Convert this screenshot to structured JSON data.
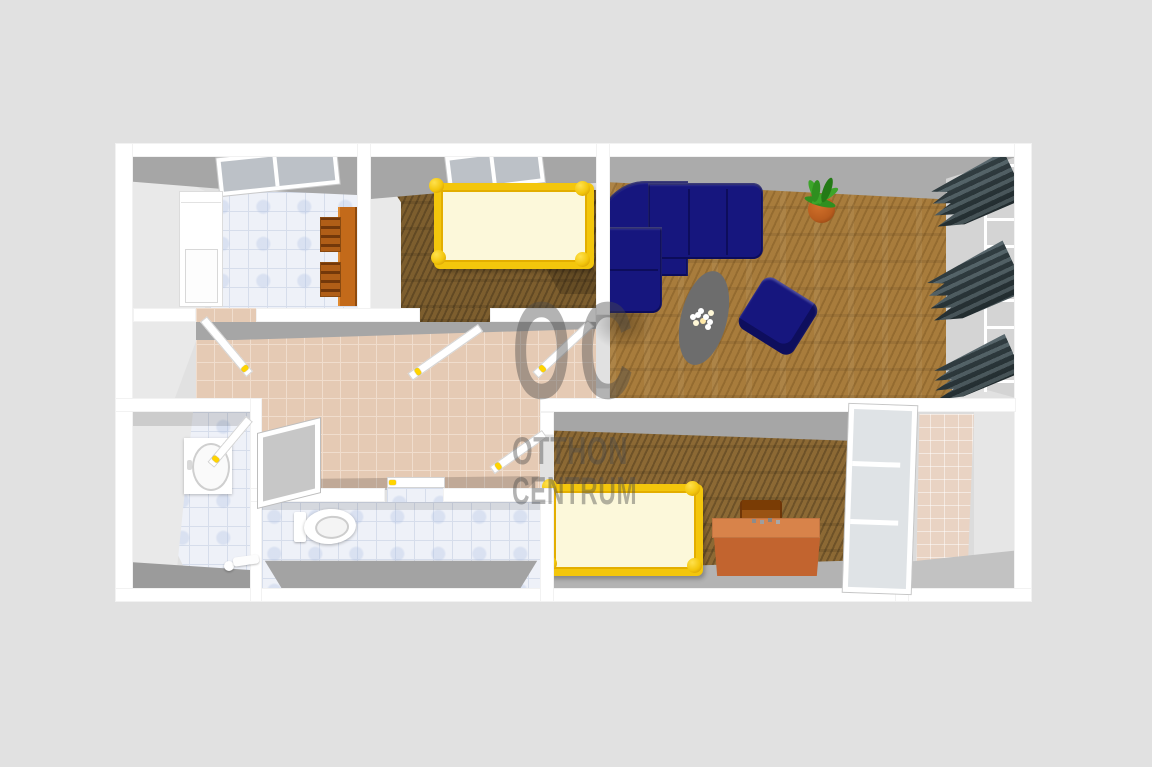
{
  "watermark": {
    "logo": "OC",
    "line1": "OTTHON",
    "line2": "CENTRUM"
  },
  "colors": {
    "background": "#e1e1e1",
    "wall": "#ffffff",
    "wall_face_light": "#e9e9e9",
    "wall_face_dark": "#a6a6a6",
    "tile_white": "#eef1f8",
    "tile_grout": "#d6ddeb",
    "tile_beige": "#e5cab4",
    "tile_beige_grout": "#f0ddcd",
    "tile_balcony": "#e9d3c3",
    "wood": "#a87c3c",
    "carpet": "#7d5e2e",
    "sofa": "#16167e",
    "sofa_dark": "#0a0a4e",
    "bed_frame": "#f3c60c",
    "bed_mattress": "#fcf8da",
    "desk": "#d8834a",
    "desk_front": "#c2642f",
    "kitchen_table": "#c36a1a",
    "chair": "#b05e17",
    "curtain": "#2e3c40",
    "plant": "#2f8f1f",
    "pot": "#b85c1e",
    "coffee_table": "#6d6d6d",
    "ceramic": "#ffffff",
    "watermark": "rgba(75,75,75,0.42)"
  },
  "rooms": [
    {
      "id": "kitchen",
      "furniture": [
        "window",
        "refrigerator",
        "dining-table",
        "chairs"
      ]
    },
    {
      "id": "bedroom-1",
      "furniture": [
        "window",
        "bed"
      ]
    },
    {
      "id": "living-room",
      "furniture": [
        "corner-sofa",
        "armchair",
        "coffee-table",
        "flowers",
        "potted-plant",
        "curtains",
        "windows"
      ]
    },
    {
      "id": "hallway",
      "furniture": [
        "doors"
      ]
    },
    {
      "id": "bathroom",
      "furniture": [
        "washbasin",
        "door",
        "faucet"
      ]
    },
    {
      "id": "wc",
      "furniture": [
        "toilet"
      ]
    },
    {
      "id": "bedroom-2",
      "furniture": [
        "bed",
        "desk",
        "chair",
        "glass-door"
      ]
    },
    {
      "id": "balcony",
      "furniture": []
    }
  ]
}
